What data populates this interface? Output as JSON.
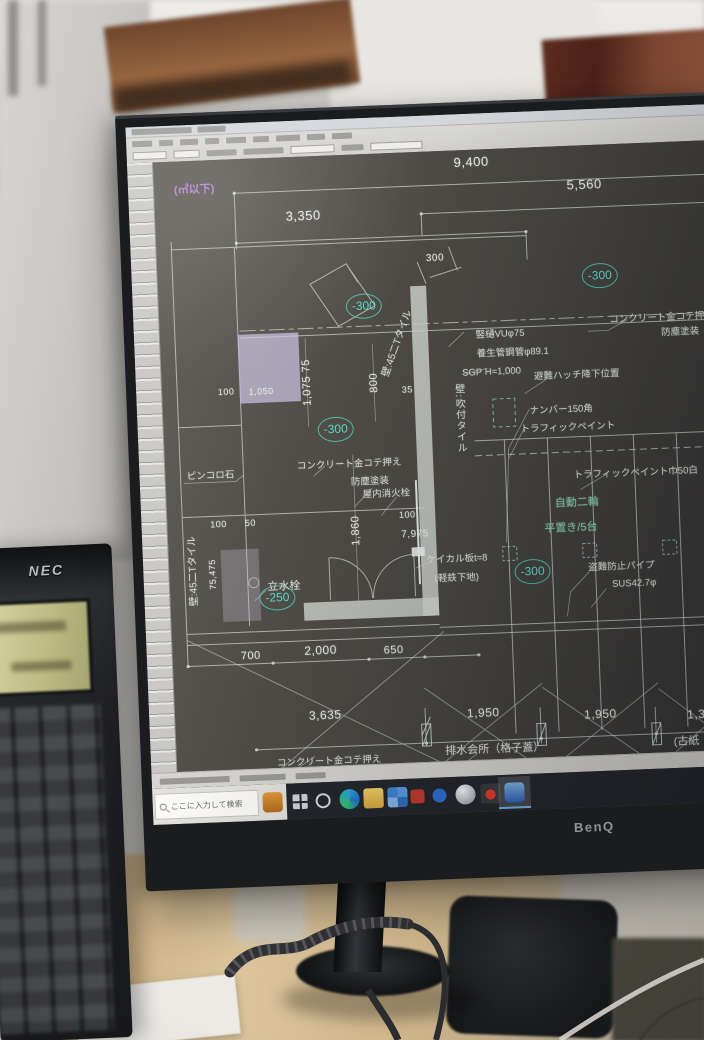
{
  "scene": {
    "monitor_brand": "BenQ",
    "phone_brand": "NEC"
  },
  "colors": {
    "elevation_teal": "#3ec9bd",
    "note_green": "#74ccae",
    "selection_purple": "#cdc6e2",
    "corner_purple": "#b77fd6",
    "drawing_line": "#d6dcd6",
    "taskbar_active_blue": "#4a90d9"
  },
  "cad": {
    "corner_note": "(㎡以下)",
    "dims": [
      "9,400",
      "5,560",
      "3,350",
      "300",
      "1,075 75",
      "800",
      "1,860",
      "100",
      "50",
      "75,475",
      "100",
      "1,050",
      "100",
      "7,975",
      "35",
      "700",
      "2,000",
      "650",
      "3,635",
      "1,950",
      "1,950",
      "1,375"
    ],
    "elevations": [
      "-300",
      "-300",
      "-300",
      "-300",
      "-250"
    ],
    "annotations": [
      "竪樋VUφ75",
      "養生管鋼管φ89.1",
      "SGP H=1,000",
      "避難ハッチ降下位置",
      "コンクリート金コテ押え",
      "防塵塗装",
      "ナンバー150角",
      "トラフィックペイント",
      "トラフィックペイント巾50白",
      "ピンコロ石",
      "コンクリート金コテ押え",
      "防塵塗装",
      "屋内消火栓",
      "ケイカル板t=8",
      "(軽鉄下地)",
      "盗難防止パイプ",
      "SUS42.7φ",
      "立水栓",
      "排水会所（格子蓋）",
      "(古紙",
      "コンクリート金コテ押え"
    ],
    "green_notes": [
      "自動二輪",
      "平置き/5台"
    ],
    "wall_notes": [
      "壁:45二Tタイル",
      "壁:吹付タイル",
      "壁:45二Tタイル"
    ]
  },
  "taskbar": {
    "search_text": "ここに入力して検索",
    "icons": [
      "search-magnifier",
      "orange-app",
      "task-view",
      "cortana",
      "edge",
      "file-explorer",
      "blue-tiles-app",
      "red-app",
      "blue-app",
      "sphere-app",
      "acrobat",
      "active-blue-app"
    ]
  }
}
